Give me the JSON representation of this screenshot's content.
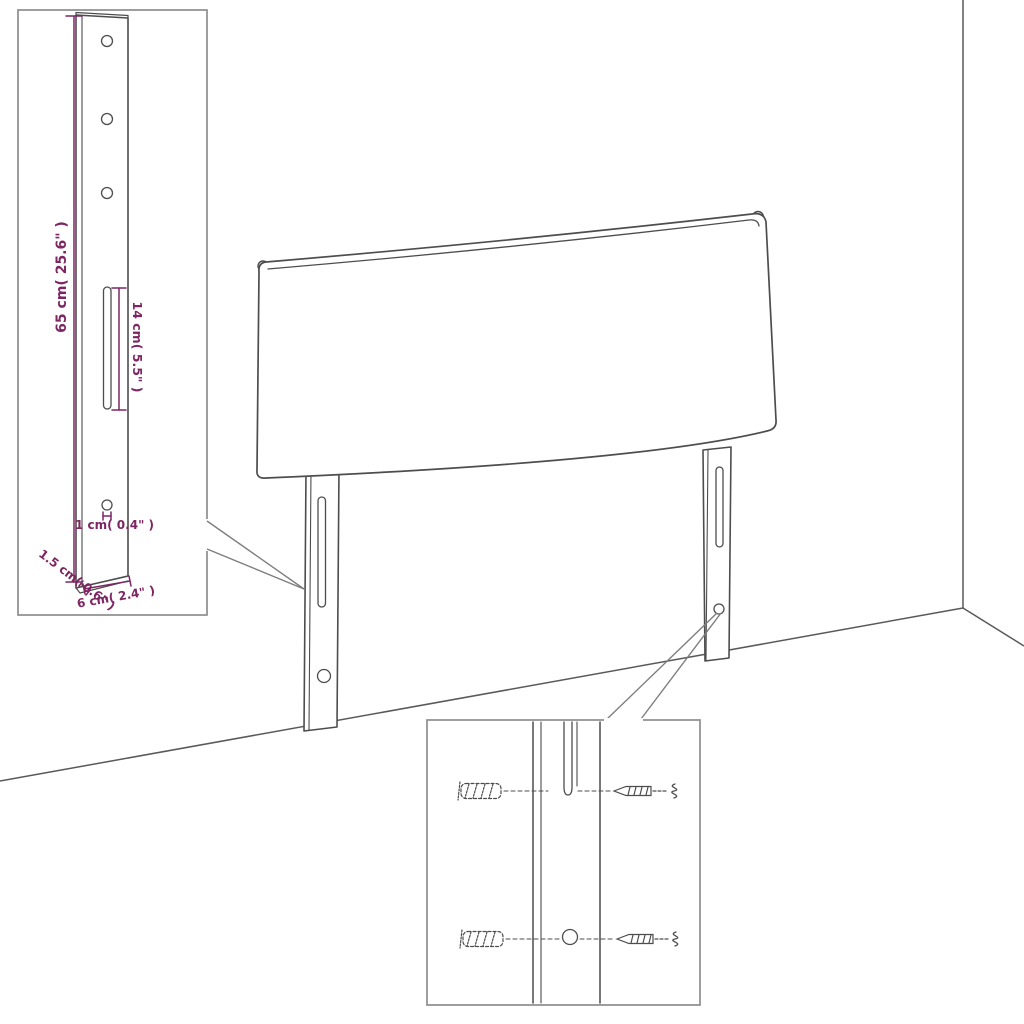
{
  "diagram": {
    "colors": {
      "dimension_text": "#7d2663",
      "drawing_line": "#4d4d4d",
      "inset_border": "#8e8e8e",
      "background": "#ffffff"
    },
    "leg_detail": {
      "height_label": "65 cm( 25.6\" )",
      "slot_label": "14 cm( 5.5\" )",
      "hole_label": "1 cm( 0.4\" )",
      "thickness_label": "1.5 cm( 0.6\" )",
      "width_label": "6 cm( 2.4\" )"
    }
  }
}
